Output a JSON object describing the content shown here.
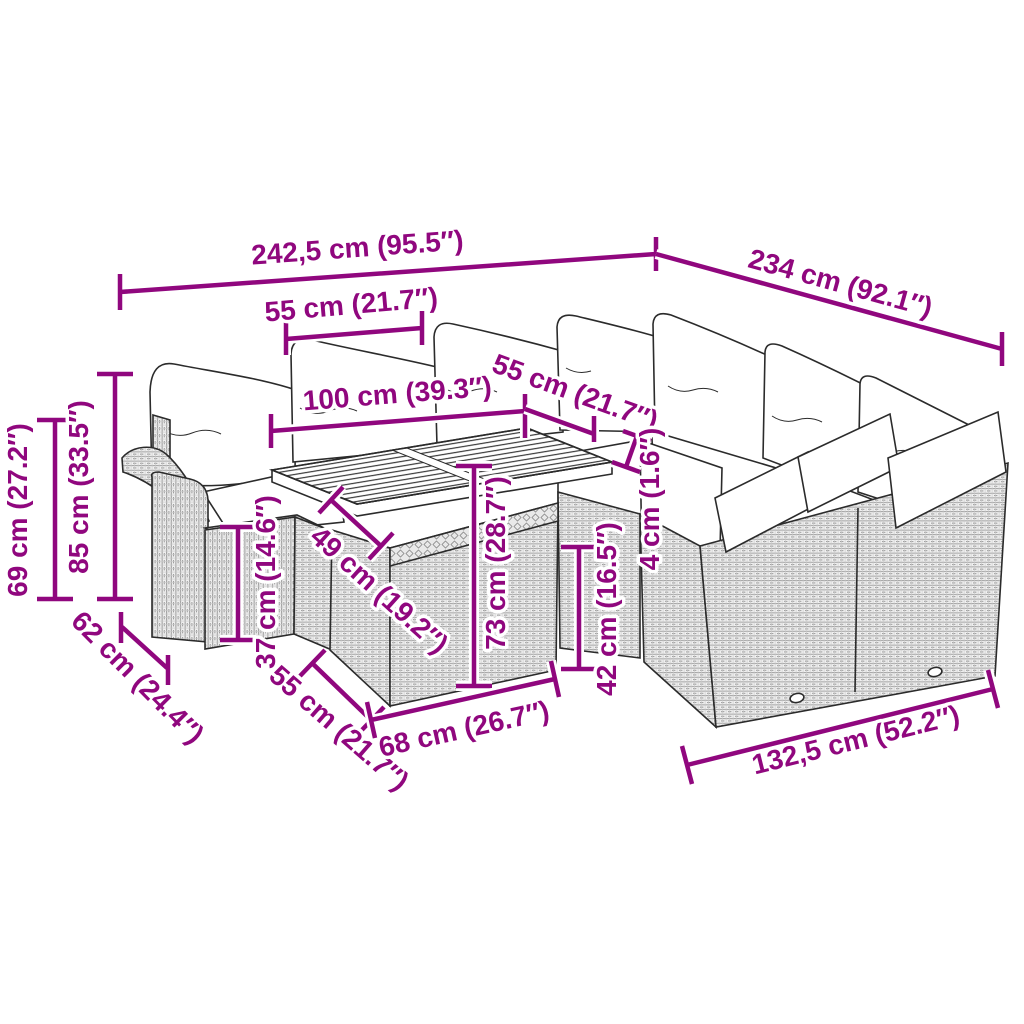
{
  "diagram": {
    "title": "product-dimension-diagram",
    "subject": "poly rattan corner garden sofa set with cushions and slatted acacia-wood table",
    "accent_color": "#90077E",
    "line_art_color": "#2b2b2b",
    "dimensions": [
      {
        "name": "overall-width-left-run",
        "label": "242,5 cm (95.5″)"
      },
      {
        "name": "overall-width-right-run",
        "label": "234 cm (92.1″)"
      },
      {
        "name": "module-width-top",
        "label": "55 cm (21.7″)"
      },
      {
        "name": "table-length",
        "label": "100 cm (39.3″)"
      },
      {
        "name": "module-depth-top",
        "label": "55 cm (21.7″)"
      },
      {
        "name": "armrest-height",
        "label": "69 cm (27.2″)"
      },
      {
        "name": "back-height",
        "label": "85 cm (33.5″)"
      },
      {
        "name": "stool-depth",
        "label": "62 cm (24.4″)"
      },
      {
        "name": "stool-height",
        "label": "37 cm (14.6″)"
      },
      {
        "name": "tabletop-depth",
        "label": "49 cm (19.2″)"
      },
      {
        "name": "table-height",
        "label": "73 cm (28.7″)"
      },
      {
        "name": "tabletop-thickness",
        "label": "4 cm (1.6″)"
      },
      {
        "name": "seat-height",
        "label": "42 cm (16.5″)"
      },
      {
        "name": "table-base-depth",
        "label": "55 cm (21.7″)"
      },
      {
        "name": "table-base-width",
        "label": "68 cm (26.7″)"
      },
      {
        "name": "right-module-width",
        "label": "132,5 cm (52.2″)"
      }
    ]
  }
}
